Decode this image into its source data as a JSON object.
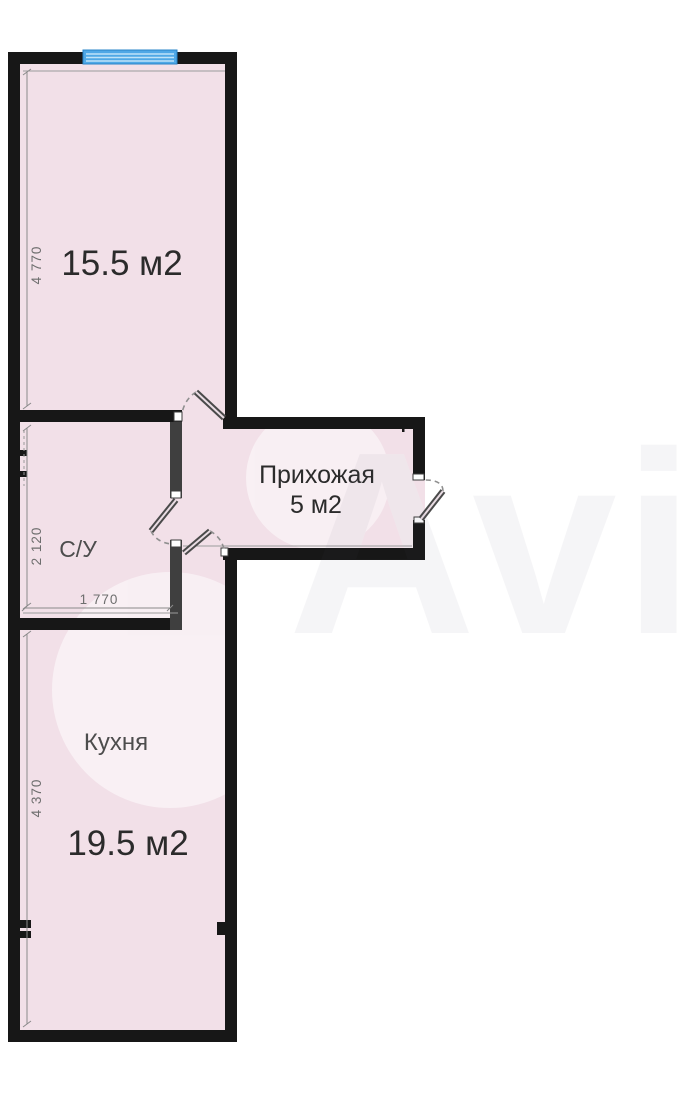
{
  "watermark": {
    "text": "Avito"
  },
  "floor_plan": {
    "rooms": {
      "living": {
        "area_label": "15.5 м2"
      },
      "hallway": {
        "name_label": "Прихожая",
        "area_label": "5 м2"
      },
      "bathroom": {
        "name_label": "С/У"
      },
      "kitchen": {
        "name_label": "Кухня",
        "area_label": "19.5 м2"
      }
    },
    "dimensions": {
      "living_wall_mm": "4 770",
      "bathroom_wall_mm": "2 120",
      "bathroom_width_mm": "1 770",
      "kitchen_wall_mm": "4 370"
    },
    "colors": {
      "floor_fill": "#f2e0e8",
      "outer_wall": "#171717",
      "partition_wall": "#3f3f3f",
      "window_blue": "#4fa8e6",
      "window_stripe": "#bfe3f8",
      "dimension_text": "#6e6e6e",
      "label_text": "#2b2b2b"
    }
  }
}
